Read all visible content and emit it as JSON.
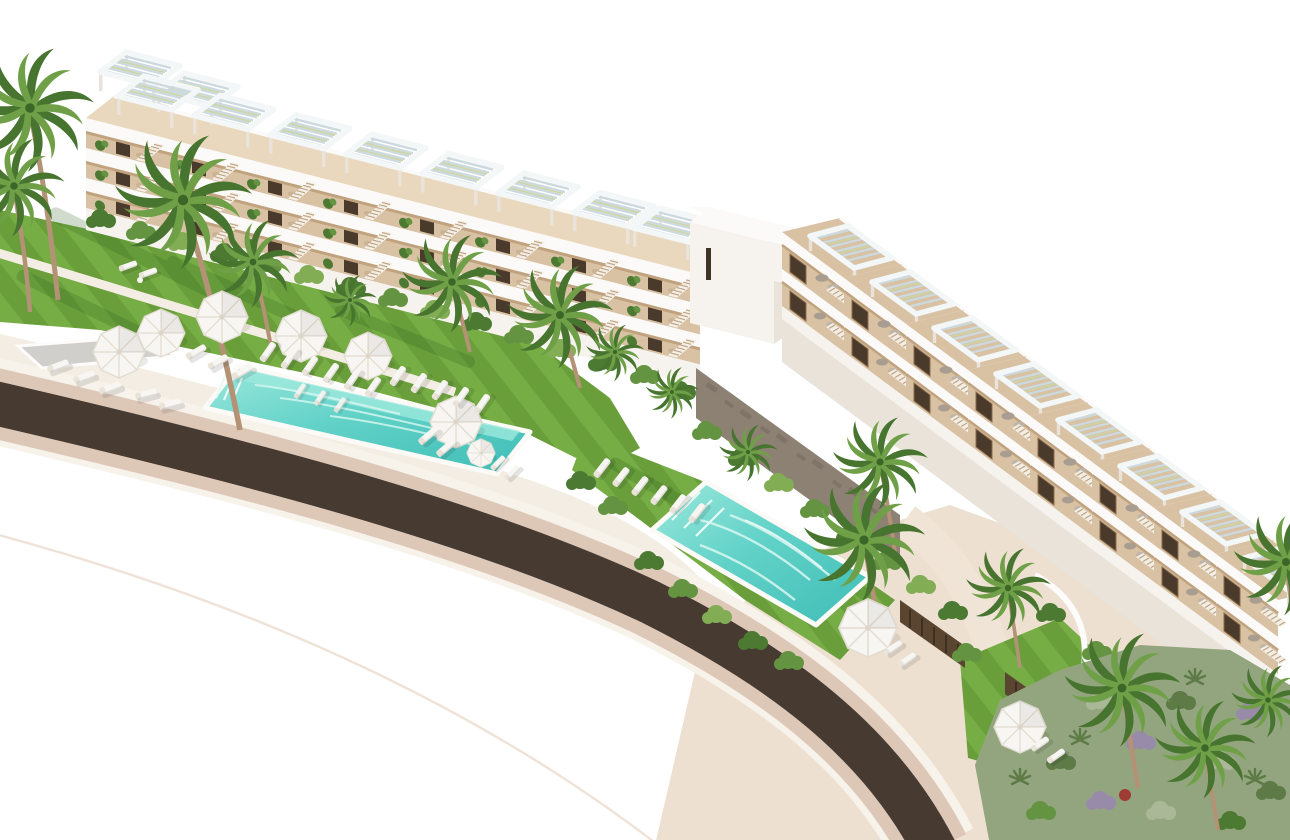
{
  "scene": {
    "type": "architectural-aerial-render",
    "description": "Aerial 3D rendering of a white Mediterranean residential complex: two terraced apartment buildings with slatted rooftop pergolas and wooden deck terraces, striped green lawns with white parasols and sun loungers, two turquoise swimming pools, palm trees, lush garden beds and a dark curved asphalt road with beige curbs sweeping across the lower left of the image on a pure white background."
  },
  "inventory": {
    "buildings": 2,
    "pools": 2,
    "parasols": 9,
    "rooftop_pergolas_left_building": 8,
    "rooftop_pergolas_right_building": 8,
    "palm_trees": 16,
    "sun_lounger_clusters": 7,
    "roads": 1
  },
  "palette": {
    "bg": "#ffffff",
    "white_hi": "#fbfaf8",
    "white": "#f6f3ee",
    "white_shade": "#e9e3da",
    "white_dark": "#ddd5c9",
    "deck": "#d9c2a4",
    "deck_light": "#e9d8bd",
    "deck_shadow": "#c0a37e",
    "door_dark": "#4a3a2b",
    "wood_frame": "#8a6a4b",
    "slat": "#ccd9df",
    "slat_green": "#ccd6a4",
    "pergola_white": "#f4f7f8",
    "road": "#463a31",
    "curb": "#ddc8b8",
    "pavement": "#eee0d1",
    "promenade": "#f3ede3",
    "path_faint": "#efe3d8",
    "lawn_a": "#77ad45",
    "lawn_b": "#699e3b",
    "lawn_shadow": "#2c5a1b",
    "hedge_dark": "#4c7a33",
    "hedge_mid": "#649441",
    "hedge_light": "#82ad54",
    "pool_deep": "#3fbdb6",
    "pool_mid": "#62d2c8",
    "pool_light": "#9ce8dc",
    "pool_foam": "#d8f7f0",
    "palm_dark": "#47742f",
    "palm_light": "#6fa047",
    "trunk": "#b39276",
    "umbrella": "#f8f6f2",
    "umbrella_shade": "#e2dcd1",
    "beanbag": "#a89d90",
    "beanbag_light": "#beb4a7",
    "stone": "#8d8174",
    "stone_dark": "#746a5e",
    "platform": "#d1cfcc",
    "sage": "#93a57f",
    "sage_light": "#abb898",
    "sage_dark": "#5d7a47",
    "purple": "#988ba9",
    "accent_red": "#9e3b32"
  }
}
